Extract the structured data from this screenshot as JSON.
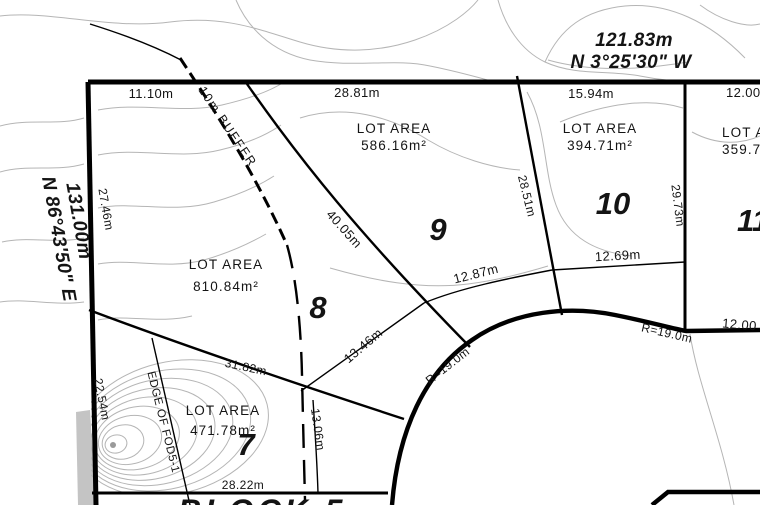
{
  "lots": [
    {
      "number": "7",
      "area_label": "LOT AREA",
      "area_value": "471.78m²"
    },
    {
      "number": "8",
      "area_label": "LOT AREA",
      "area_value": "810.84m²"
    },
    {
      "number": "9",
      "area_label": "LOT AREA",
      "area_value": "586.16m²"
    },
    {
      "number": "10",
      "area_label": "LOT AREA",
      "area_value": "394.71m²"
    },
    {
      "number": "11",
      "area_label": "LOT AREA",
      "area_value": "359.7"
    }
  ],
  "bearings": {
    "north": {
      "length": "121.83m",
      "bearing": "N 3°25'30\" W"
    },
    "west": {
      "length": "131.00m",
      "bearing": "N 86°43'50\" E"
    }
  },
  "annotations": {
    "buffer": "10m BUFFER",
    "edge": "EDGE OF FOD5-1",
    "block": "BLOCK 5"
  },
  "dimensions": {
    "top_seg1": "11.10m",
    "top_seg2": "28.81m",
    "top_seg3": "15.94m",
    "top_seg4": "12.00",
    "west_seg1": "27.46m",
    "west_seg2": "22.54m",
    "lot7_north": "31.82m",
    "lot7_east": "13.06m",
    "lot7_south": "28.22m",
    "lot8_lot9": "40.05m",
    "lot8_south": "13.46m",
    "lot9_south": "12.87m",
    "lot9_lot10": "28.51m",
    "lot10_south": "12.69m",
    "lot10_lot11": "29.73m",
    "lot11_road": "12.00",
    "radius_sw": "R=19.0m",
    "radius_ne": "R=19.0m"
  },
  "colors": {
    "line": "#000000",
    "contour": "#b5b5b5",
    "background": "#ffffff"
  }
}
